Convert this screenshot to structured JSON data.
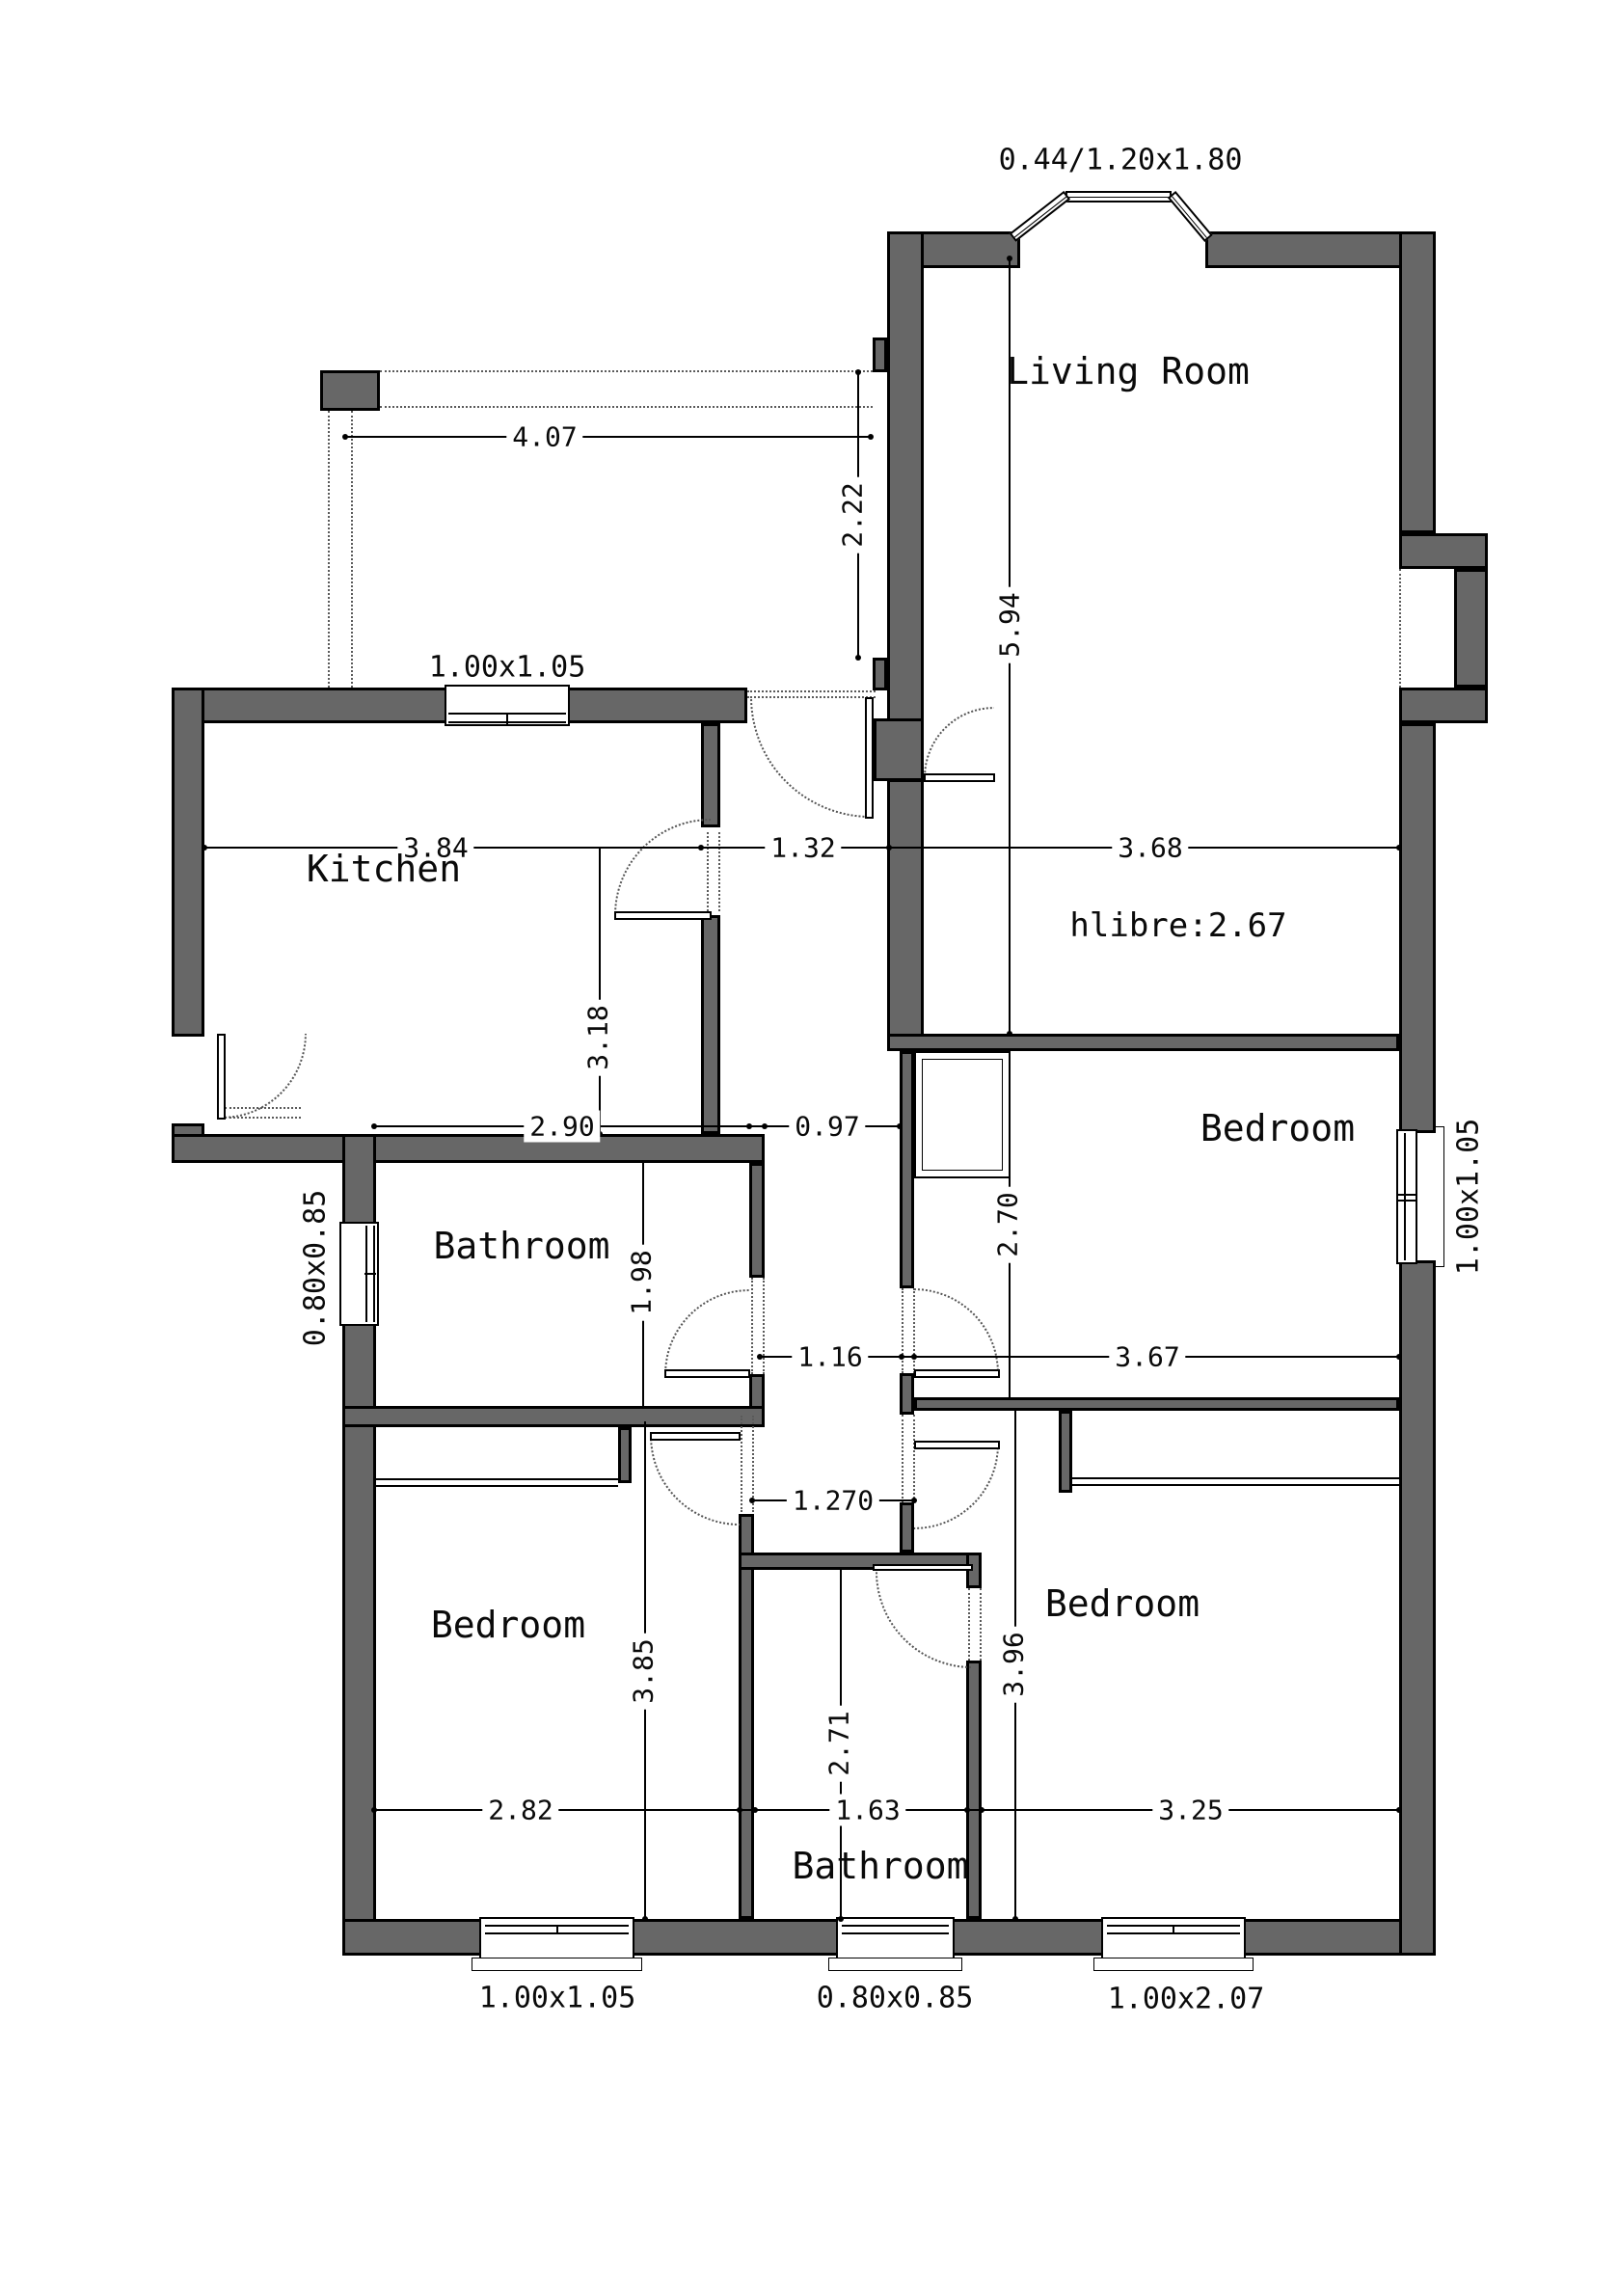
{
  "type": "architectural floor plan",
  "colors": {
    "wall_fill": "#676767",
    "outline": "#000000",
    "dotted_guides": "#5a5a5a",
    "background": "#ffffff"
  },
  "rooms": {
    "living_room": "Living Room",
    "kitchen": "Kitchen",
    "bathroom_top": "Bathroom",
    "bedroom_right": "Bedroom",
    "bedroom_bottom_left": "Bedroom",
    "bedroom_bottom_right": "Bedroom",
    "bathroom_bottom": "Bathroom"
  },
  "annotations": {
    "ceiling_height": "hlibre:2.67",
    "bay_window": "0.44/1.20x1.80"
  },
  "windows": {
    "kitchen_top": "1.00x1.05",
    "left": "0.80x0.85",
    "right": "1.00x1.05",
    "bottom_left": "1.00x1.05",
    "bottom_middle": "0.80x0.85",
    "bottom_right": "1.00x2.07"
  },
  "dimensions_m": {
    "h_4_07": "4.07",
    "h_3_84": "3.84",
    "h_1_32": "1.32",
    "h_3_68": "3.68",
    "h_2_90": "2.90",
    "h_0_97": "0.97",
    "h_1_16": "1.16",
    "h_3_67": "3.67",
    "h_1_270": "1.270",
    "h_2_82": "2.82",
    "h_1_63": "1.63",
    "h_3_25": "3.25",
    "v_2_22": "2.22",
    "v_5_94": "5.94",
    "v_3_18": "3.18",
    "v_1_98": "1.98",
    "v_2_70": "2.70",
    "v_3_85": "3.85",
    "v_2_71": "2.71",
    "v_3_96": "3.96"
  }
}
